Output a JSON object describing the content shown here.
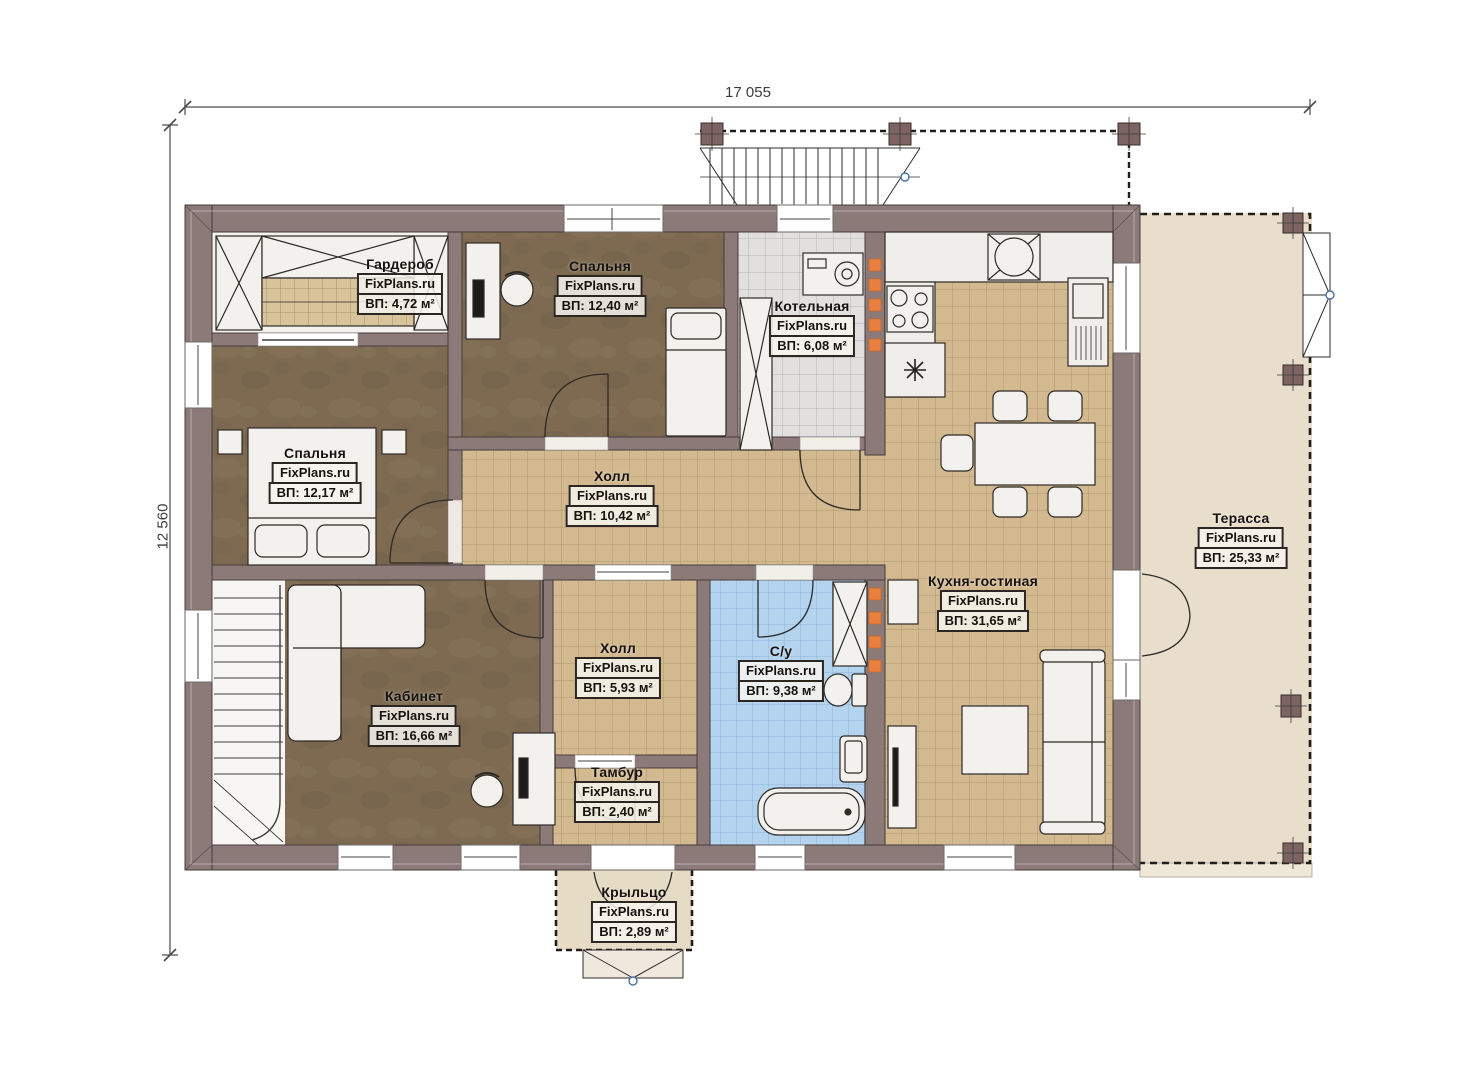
{
  "watermark": "FixPlans.ru",
  "dimensions": {
    "top": "17 055",
    "left": "12 560"
  },
  "rooms": [
    {
      "key": "wardrobe",
      "name": "Гардероб",
      "area": "ВП: 4,72 м²"
    },
    {
      "key": "bedroom-top",
      "name": "Спальня",
      "area": "ВП: 12,40 м²"
    },
    {
      "key": "boiler-room",
      "name": "Котельная",
      "area": "ВП: 6,08 м²"
    },
    {
      "key": "bedroom-left",
      "name": "Спальня",
      "area": "ВП: 12,17 м²"
    },
    {
      "key": "hall-main",
      "name": "Холл",
      "area": "ВП: 10,42 м²"
    },
    {
      "key": "kitchen-living",
      "name": "Кухня-гостиная",
      "area": "ВП: 31,65 м²"
    },
    {
      "key": "terrace",
      "name": "Терасса",
      "area": "ВП: 25,33 м²"
    },
    {
      "key": "hall-small",
      "name": "Холл",
      "area": "ВП: 5,93 м²"
    },
    {
      "key": "bathroom",
      "name": "С/у",
      "area": "ВП: 9,38 м²"
    },
    {
      "key": "office",
      "name": "Кабинет",
      "area": "ВП: 16,66 м²"
    },
    {
      "key": "vestibule",
      "name": "Тамбур",
      "area": "ВП: 2,40 м²"
    },
    {
      "key": "porch",
      "name": "Крыльцо",
      "area": "ВП: 2,89 м²"
    }
  ],
  "colors": {
    "wall": "#8c7a78",
    "floor_carpet": "#7d6a51",
    "tile_beige": "#d2b98f",
    "tile_gray": "#e1e0df",
    "tile_blue": "#b4d3ee",
    "terrace": "#e8decb",
    "porch": "#e6dbc5",
    "chimney_accent": "#ea8040",
    "node_blue": "#4a6fa5"
  }
}
